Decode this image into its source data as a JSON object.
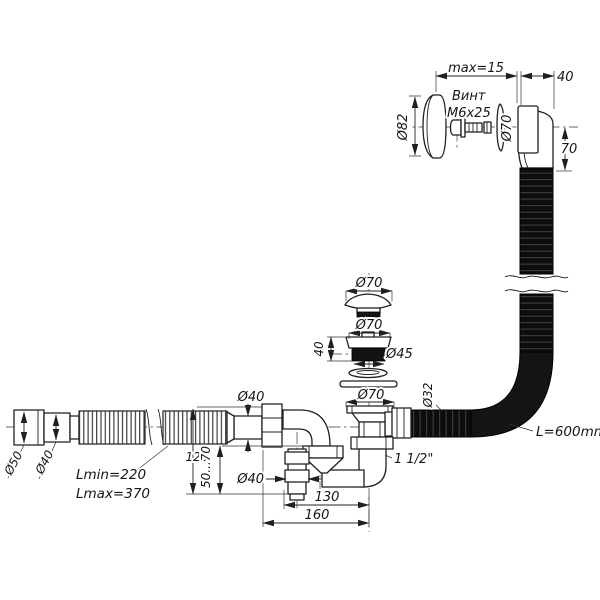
{
  "meta": {
    "description": "Exploded technical drawing of a bath waste and overflow siphon set",
    "bg": "#ffffff",
    "line_color": "#1f1f1f",
    "hose_color": "#101010"
  },
  "overflow": {
    "plate_dia": "Ø82",
    "screw_name": "Винт",
    "screw_spec": "М6х25",
    "gasket_dia": "Ø70",
    "gap_max": "max=15",
    "body_width": "40",
    "drop_height": "70",
    "hose_dia": "Ø32",
    "hose_length": "L=600mm"
  },
  "drain": {
    "cap_dia": "Ø70",
    "flange_dia": "Ø70",
    "body_height": "40",
    "thread_dia": "Ø45",
    "seal_dia": "Ø70",
    "connection": "1 1/2\""
  },
  "siphon": {
    "inlet_dia": "Ø40",
    "tube_dia": "Ø40",
    "height": "120",
    "adjust_range": "50...70",
    "offset": "130",
    "length": "160"
  },
  "outlet": {
    "cuff_dia": "Ø50",
    "pipe_dia": "Ø40",
    "len_min": "Lmin=220",
    "len_max": "Lmax=370"
  }
}
